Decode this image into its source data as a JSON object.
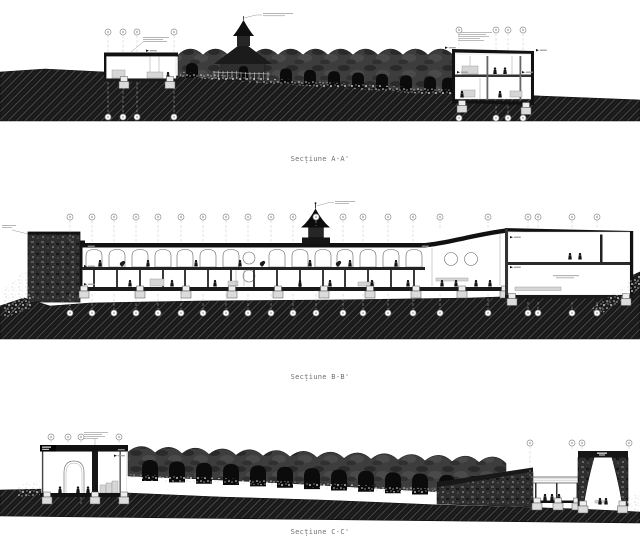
{
  "sheet": {
    "background": "#ffffff",
    "sections": [
      {
        "id": "A",
        "caption": "Secțiune A-A'"
      },
      {
        "id": "B",
        "caption": "Secțiune B-B'"
      },
      {
        "id": "C",
        "caption": "Secțiune C-C'"
      }
    ]
  },
  "colors": {
    "ink": "#111111",
    "facade": "#3a3a3a",
    "ground": "#181818",
    "hatch_line": "#4d4d4d",
    "stone": "#2e2e2e",
    "caption_text": "#6f6f6f"
  }
}
